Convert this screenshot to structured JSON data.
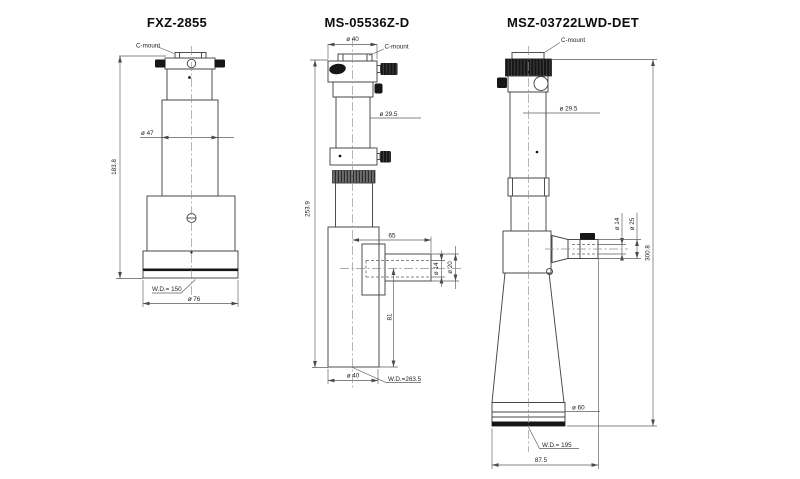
{
  "meta": {
    "background": "#ffffff",
    "line_color": "#464646",
    "text_color": "#1e1e1e",
    "drawing_type": "microscope lens unit dimensional drawings"
  },
  "drawings": [
    {
      "id": "fxz-2855",
      "title": "FXZ-2855",
      "labels": {
        "c_mount": "C-mount",
        "dia_body": "ø 47",
        "overall_height": "183.8",
        "working_distance": "W.D.= 150",
        "dia_base": "ø 76"
      }
    },
    {
      "id": "ms-05536z-d",
      "title": "MS-05536Z-D",
      "labels": {
        "dia_top": "ø 40",
        "c_mount": "C-mount",
        "dia_tube": "ø 29.5",
        "overall_height": "253.9",
        "port_length": "65",
        "dia_port_hole": "ø 14",
        "dia_port": "ø 20",
        "port_axis_height": "81",
        "dia_base": "ø 40",
        "working_distance": "W.D.=263.5"
      }
    },
    {
      "id": "msz-03722lwd-det",
      "title": "MSZ-03722LWD-DET",
      "labels": {
        "c_mount": "C-mount",
        "dia_tube": "ø 29.5",
        "dia_port_hole": "ø 14",
        "dia_port": "ø 25",
        "overall_height": "300.8",
        "dia_base": "ø  60",
        "working_distance": "W.D.= 195",
        "base_width": "87.5"
      }
    }
  ]
}
